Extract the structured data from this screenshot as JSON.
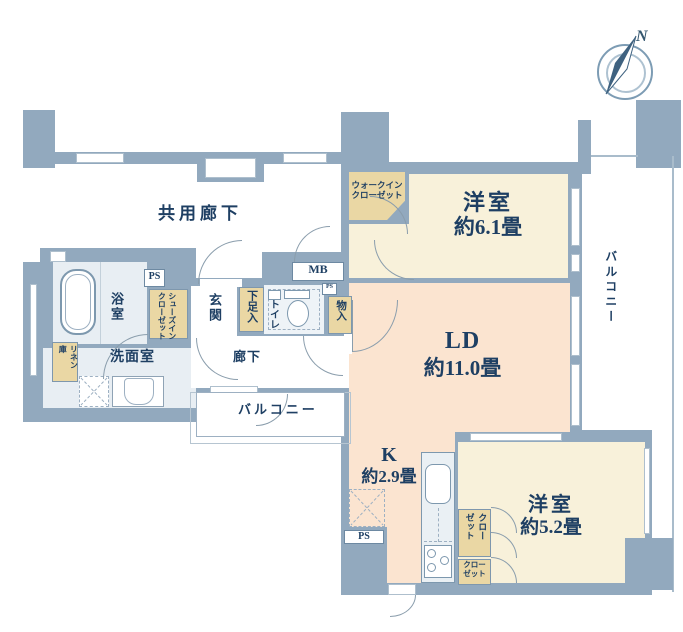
{
  "meta": {
    "kind": "japanese-apartment-floor-plan"
  },
  "palette": {
    "wall": "#92a9be",
    "room_cream": "#f8f1da",
    "room_peach": "#fbe4d0",
    "room_wet": "#e8eef3",
    "closet_tan": "#ead7a4",
    "text_navy": "#1e3f63"
  },
  "labels": {
    "common_corridor": "共用廊下",
    "bedroom1_name": "洋室",
    "bedroom1_size": "約6.1畳",
    "ld_name": "LD",
    "ld_size": "約11.0畳",
    "kitchen_name": "K",
    "kitchen_size": "約2.9畳",
    "bedroom2_name": "洋室",
    "bedroom2_size": "約5.2畳",
    "bath": "浴室",
    "washroom": "洗面室",
    "entrance": "玄関",
    "hallway": "廊下",
    "toilet": "トイレ",
    "shoe_box": "下足入",
    "storage_monoire": "物入",
    "wic_line1": "ウォークイン",
    "wic_line2": "クローゼット",
    "sic_line1": "シューズイン",
    "sic_line2": "クローゼット",
    "linen_line1": "リネン",
    "linen_line2": "庫",
    "closet_a_line1": "クロー",
    "closet_a_line2": "ゼット",
    "closet_b_line1": "クロー",
    "closet_b_line2": "ゼット",
    "balcony_bottom": "バルコニー",
    "balcony_right": "バルコニー",
    "mb": "MB",
    "ps_bath": "PS",
    "ps_kitchen": "PS",
    "ps_small": "PS",
    "compass_north": "N"
  }
}
